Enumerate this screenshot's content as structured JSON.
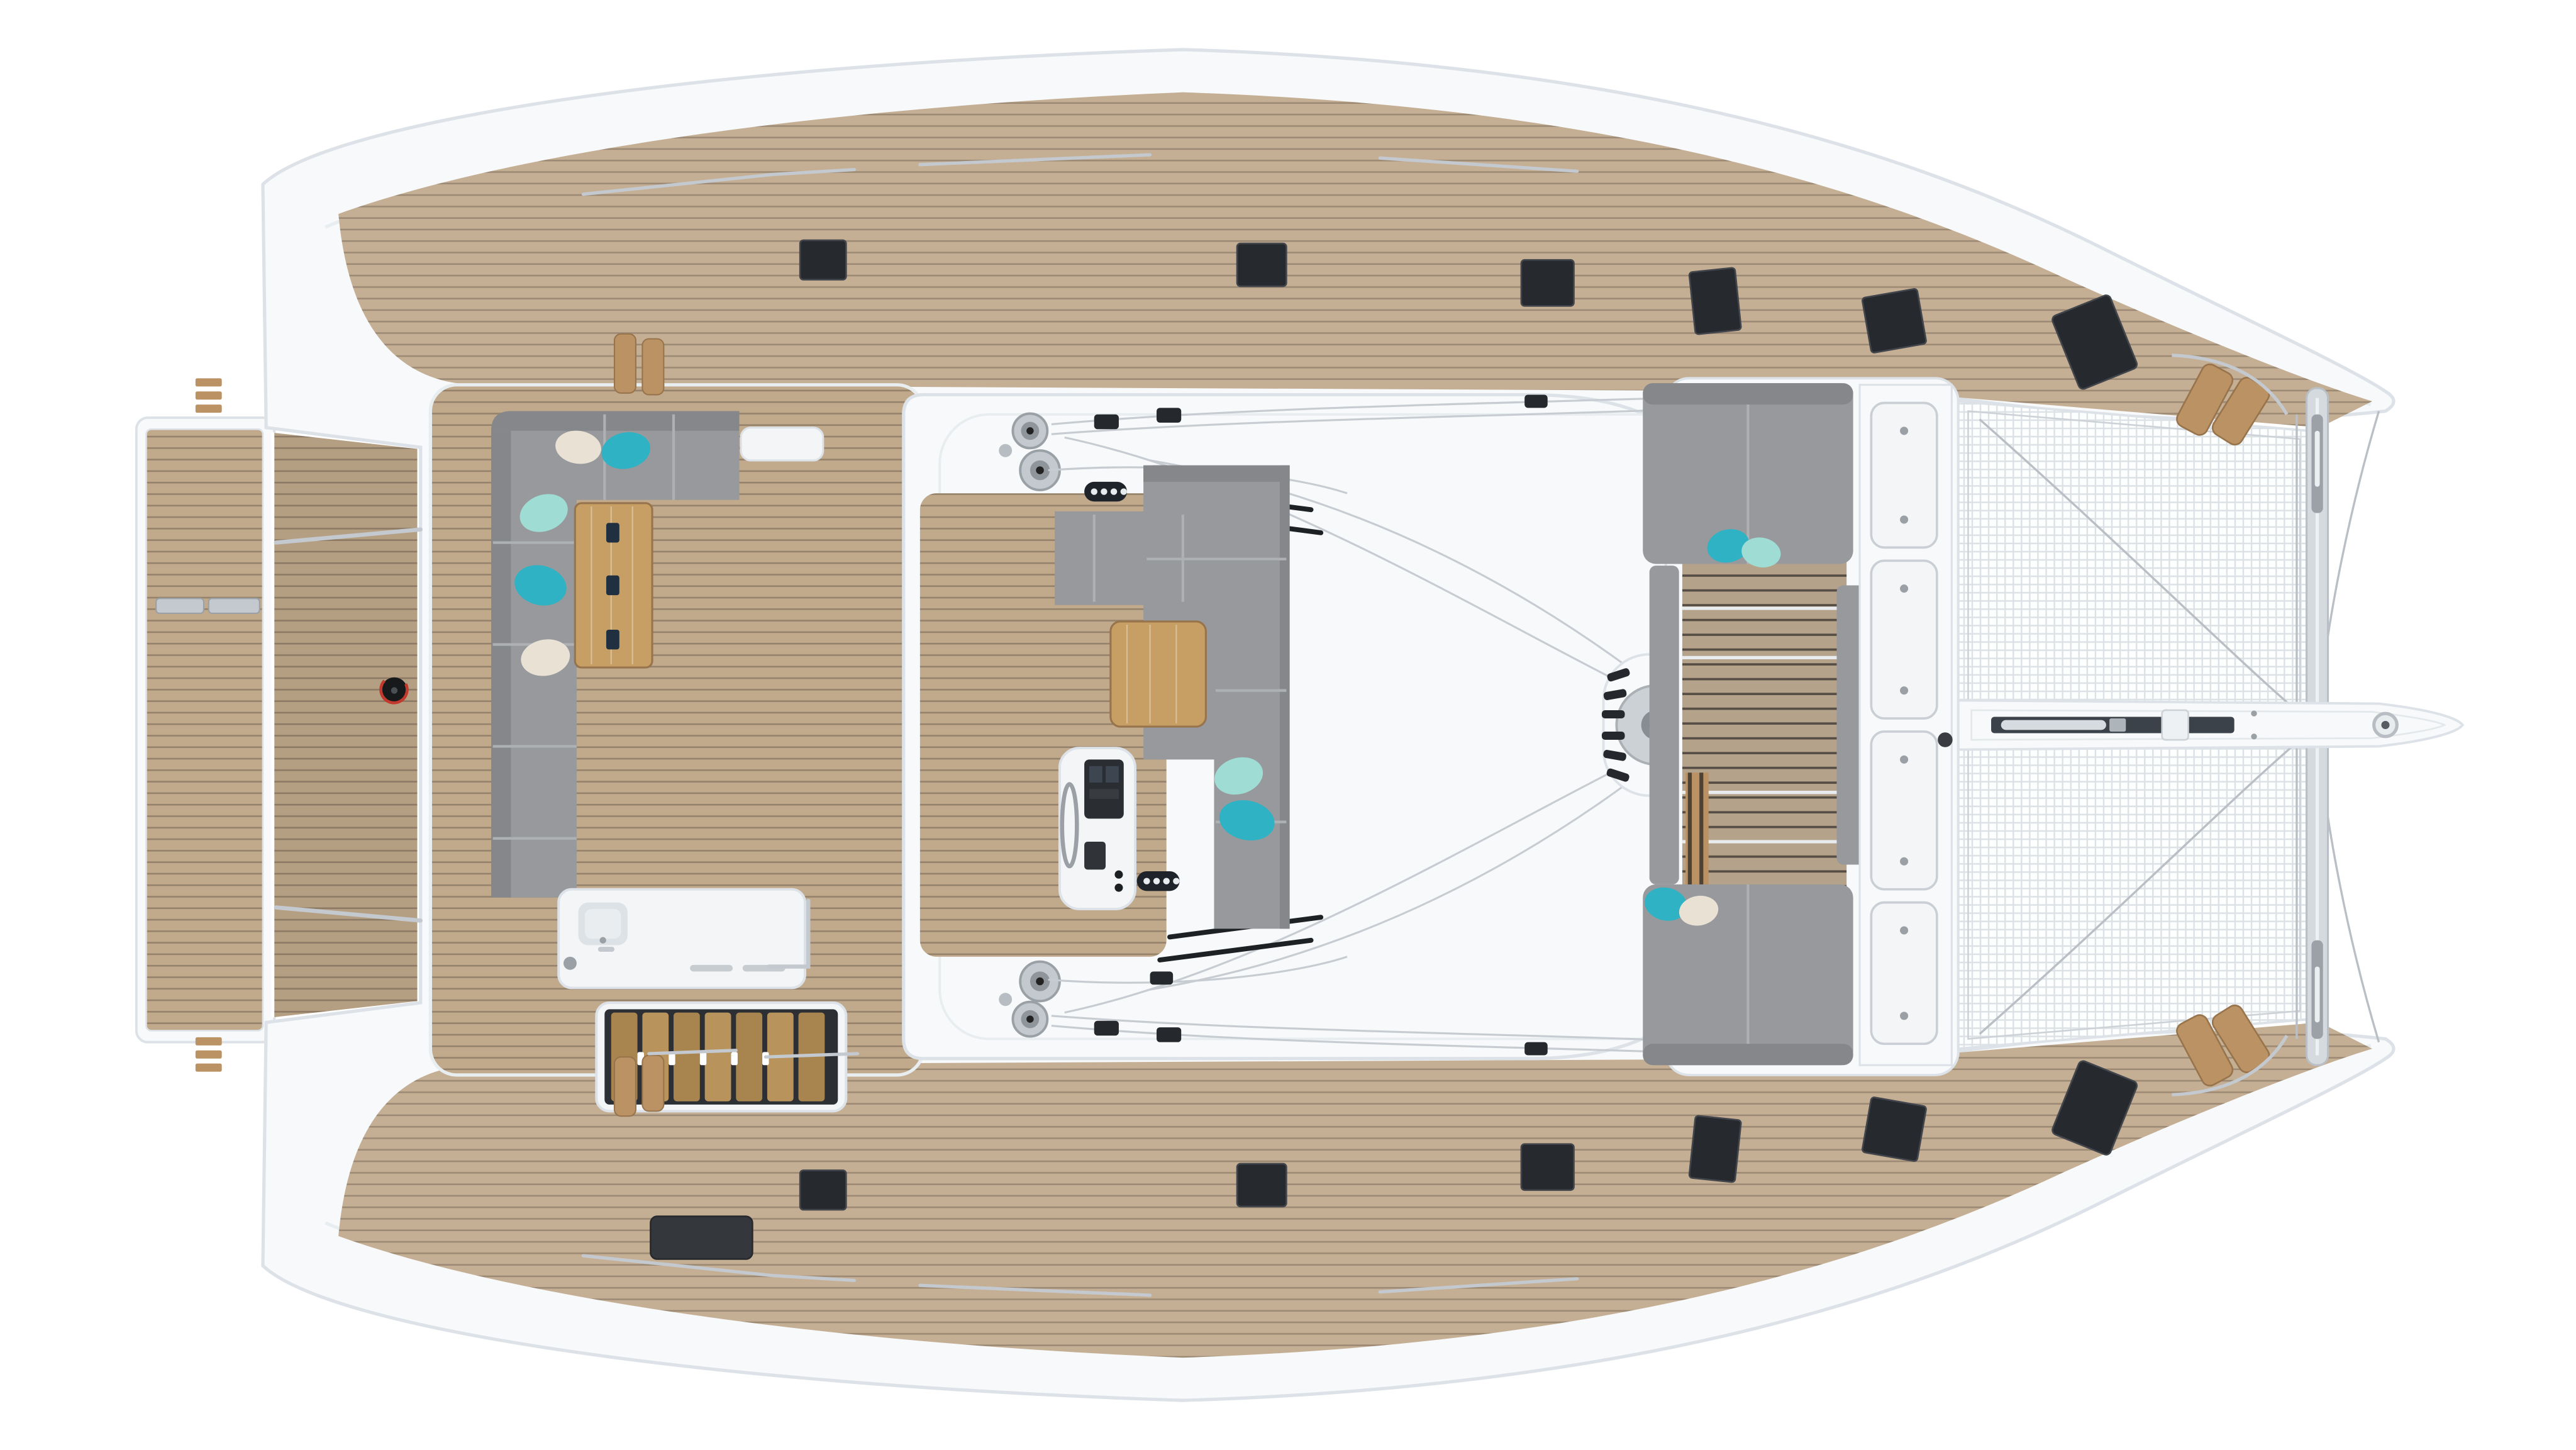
{
  "scene": {
    "title": "Catamaran sailing yacht — top view deck plan render",
    "background": "#ffffff"
  },
  "colors": {
    "hull": "#f7f9fa",
    "hullEdge": "#dce2e7",
    "hullLine": "#e8edf0",
    "teak": "#c1a98c",
    "teakSeam": "#7e6e59",
    "teakShade": "#ad9679",
    "teakBold": "#b5a28a",
    "teakBoldSeam": "#3e3a33",
    "woodSeat": "#bb9264",
    "woodEdge": "#97744c",
    "table": "#c79e63",
    "cushion": "#97999c",
    "cushionDark": "#85878a",
    "cushionSeam": "#aeb1b4",
    "teal": "#2fb3c4",
    "mint": "#9fdcd4",
    "beige": "#e9e1d4",
    "hatch": "#26292d",
    "hatchEdge": "#42464c",
    "chrome": "#c3c9ce",
    "chromeDark": "#99a0a6",
    "rope": "#c6ccd1",
    "dark": "#25282c",
    "red": "#c23a2e",
    "mesh": "#dce1e5",
    "white": "#f3f5f7"
  },
  "components": [
    "swim-platform",
    "transom-deck",
    "hull-body",
    "side-deck-top",
    "side-deck-bottom",
    "deck-hatches",
    "aft-cockpit",
    "cockpit-sofa",
    "cockpit-pillows",
    "cockpit-table",
    "wet-bar",
    "companionway-stairs",
    "liferaft-locker",
    "flybridge",
    "winches",
    "rope-clutches",
    "rigging-lines",
    "helm-station",
    "helm-wheel",
    "flybridge-lounge",
    "flybridge-table",
    "sunpad-pillows",
    "mast-base",
    "forward-cockpit",
    "forward-seats",
    "deck-lockers",
    "trampoline",
    "crossbeam",
    "bowsprit",
    "bow-seats",
    "fuel-gauge"
  ]
}
